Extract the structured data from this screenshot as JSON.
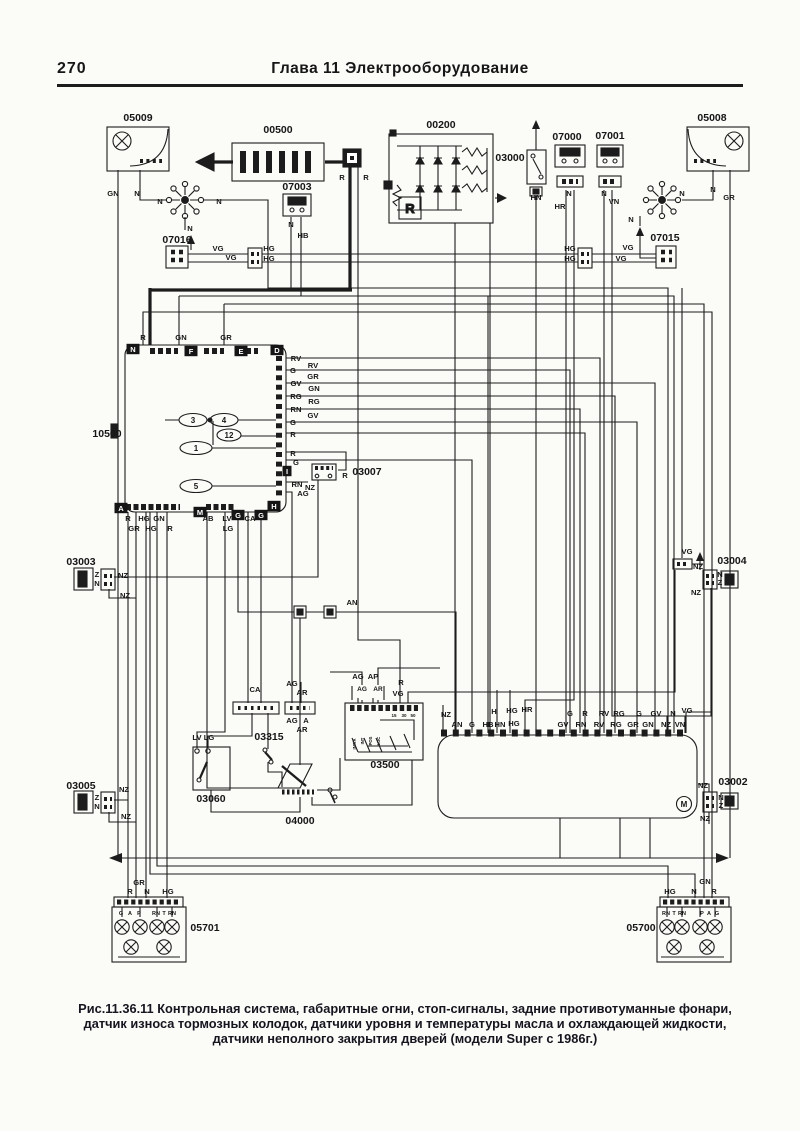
{
  "page": {
    "number": "270",
    "header": "Глава 11  Электрооборудование"
  },
  "caption": [
    "Рис.11.36.11 Контрольная система, габаритные огни, стоп-сигналы, задние противотуманные фонари,",
    "датчик износа тормозных колодок, датчики уровня и температуры масла и охлаждающей жидкости,",
    "датчики неполного закрытия дверей (модели Super с 1986г.)"
  ],
  "diagram": {
    "alternator_r": "R",
    "components": [
      {
        "id": "05009",
        "x": 138,
        "y": 121
      },
      {
        "id": "00500",
        "x": 278,
        "y": 133
      },
      {
        "id": "07003",
        "x": 297,
        "y": 190
      },
      {
        "id": "00200",
        "x": 441,
        "y": 128
      },
      {
        "id": "03000",
        "x": 510,
        "y": 161
      },
      {
        "id": "07000",
        "x": 567,
        "y": 140
      },
      {
        "id": "07001",
        "x": 610,
        "y": 139
      },
      {
        "id": "05008",
        "x": 712,
        "y": 121
      },
      {
        "id": "07016",
        "x": 177,
        "y": 243
      },
      {
        "id": "07015",
        "x": 665,
        "y": 241
      },
      {
        "id": "10500",
        "x": 107,
        "y": 437
      },
      {
        "id": "03007",
        "x": 367,
        "y": 475
      },
      {
        "id": "03003",
        "x": 81,
        "y": 565
      },
      {
        "id": "03004",
        "x": 732,
        "y": 564
      },
      {
        "id": "03005",
        "x": 81,
        "y": 789
      },
      {
        "id": "03002",
        "x": 733,
        "y": 785
      },
      {
        "id": "03315",
        "x": 269,
        "y": 740
      },
      {
        "id": "03060",
        "x": 211,
        "y": 802
      },
      {
        "id": "04000",
        "x": 300,
        "y": 824
      },
      {
        "id": "03500",
        "x": 385,
        "y": 768
      },
      {
        "id": "05701",
        "x": 205,
        "y": 931
      },
      {
        "id": "05700",
        "x": 641,
        "y": 931
      }
    ],
    "badges": [
      {
        "t": "N",
        "x": 133,
        "y": 349
      },
      {
        "t": "F",
        "x": 191,
        "y": 351
      },
      {
        "t": "E",
        "x": 241,
        "y": 351
      },
      {
        "t": "D",
        "x": 277,
        "y": 350
      },
      {
        "t": "A",
        "x": 121,
        "y": 508
      },
      {
        "t": "M",
        "x": 200,
        "y": 512
      },
      {
        "t": "G",
        "x": 238,
        "y": 515
      },
      {
        "t": "G",
        "x": 261,
        "y": 515
      },
      {
        "t": "H",
        "x": 274,
        "y": 506
      },
      {
        "t": "I",
        "x": 287,
        "y": 471
      }
    ],
    "oval_numbers": [
      {
        "t": "3",
        "x": 193,
        "y": 423
      },
      {
        "t": "4",
        "x": 224,
        "y": 423
      },
      {
        "t": "12",
        "x": 229,
        "y": 438
      },
      {
        "t": "1",
        "x": 196,
        "y": 451
      },
      {
        "t": "5",
        "x": 196,
        "y": 489
      }
    ],
    "switch_labels": [
      {
        "t": "INT/A",
        "x": 356,
        "y": 744
      },
      {
        "t": "INT",
        "x": 364,
        "y": 741
      },
      {
        "t": "POS",
        "x": 372,
        "y": 741
      },
      {
        "t": "LUC",
        "x": 380,
        "y": 741
      }
    ],
    "wire_labels": [
      {
        "t": "GN",
        "x": 113,
        "y": 196
      },
      {
        "t": "N",
        "x": 137,
        "y": 196
      },
      {
        "t": "N",
        "x": 160,
        "y": 204
      },
      {
        "t": "N",
        "x": 219,
        "y": 204
      },
      {
        "t": "N",
        "x": 190,
        "y": 231
      },
      {
        "t": "R",
        "x": 342,
        "y": 180
      },
      {
        "t": "R",
        "x": 366,
        "y": 180
      },
      {
        "t": "N",
        "x": 291,
        "y": 227
      },
      {
        "t": "HB",
        "x": 303,
        "y": 238
      },
      {
        "t": "HN",
        "x": 536,
        "y": 200
      },
      {
        "t": "N",
        "x": 569,
        "y": 196
      },
      {
        "t": "HR",
        "x": 560,
        "y": 209
      },
      {
        "t": "N",
        "x": 604,
        "y": 196
      },
      {
        "t": "VN",
        "x": 614,
        "y": 204
      },
      {
        "t": "N",
        "x": 713,
        "y": 192
      },
      {
        "t": "GR",
        "x": 729,
        "y": 200
      },
      {
        "t": "N",
        "x": 682,
        "y": 196
      },
      {
        "t": "N",
        "x": 631,
        "y": 222
      },
      {
        "t": "VG",
        "x": 218,
        "y": 251
      },
      {
        "t": "VG",
        "x": 231,
        "y": 260
      },
      {
        "t": "HG",
        "x": 269,
        "y": 251
      },
      {
        "t": "HG",
        "x": 269,
        "y": 261
      },
      {
        "t": "HG",
        "x": 570,
        "y": 251
      },
      {
        "t": "HG",
        "x": 570,
        "y": 261
      },
      {
        "t": "VG",
        "x": 628,
        "y": 250
      },
      {
        "t": "VG",
        "x": 621,
        "y": 261
      },
      {
        "t": "R",
        "x": 143,
        "y": 340
      },
      {
        "t": "GN",
        "x": 181,
        "y": 340
      },
      {
        "t": "GR",
        "x": 226,
        "y": 340
      },
      {
        "t": "RV",
        "x": 296,
        "y": 361
      },
      {
        "t": "G",
        "x": 293,
        "y": 373
      },
      {
        "t": "GV",
        "x": 296,
        "y": 386
      },
      {
        "t": "RG",
        "x": 296,
        "y": 399
      },
      {
        "t": "RN",
        "x": 296,
        "y": 412
      },
      {
        "t": "G",
        "x": 293,
        "y": 425
      },
      {
        "t": "R",
        "x": 293,
        "y": 437
      },
      {
        "t": "R",
        "x": 293,
        "y": 456
      },
      {
        "t": "G",
        "x": 296,
        "y": 465
      },
      {
        "t": "RN",
        "x": 297,
        "y": 487
      },
      {
        "t": "AG",
        "x": 303,
        "y": 496
      },
      {
        "t": "RV",
        "x": 313,
        "y": 368
      },
      {
        "t": "GR",
        "x": 313,
        "y": 379
      },
      {
        "t": "GN",
        "x": 314,
        "y": 391
      },
      {
        "t": "RG",
        "x": 314,
        "y": 404
      },
      {
        "t": "GV",
        "x": 313,
        "y": 418
      },
      {
        "t": "NZ",
        "x": 310,
        "y": 490
      },
      {
        "t": "R",
        "x": 345,
        "y": 478
      },
      {
        "t": "R",
        "x": 128,
        "y": 521
      },
      {
        "t": "HG",
        "x": 144,
        "y": 521
      },
      {
        "t": "GN",
        "x": 159,
        "y": 521
      },
      {
        "t": "GR",
        "x": 134,
        "y": 531
      },
      {
        "t": "HG",
        "x": 151,
        "y": 531
      },
      {
        "t": "R",
        "x": 170,
        "y": 531
      },
      {
        "t": "AB",
        "x": 208,
        "y": 521
      },
      {
        "t": "LV",
        "x": 227,
        "y": 521
      },
      {
        "t": "LG",
        "x": 228,
        "y": 531
      },
      {
        "t": "CA",
        "x": 250,
        "y": 521
      },
      {
        "t": "Z",
        "x": 97,
        "y": 577
      },
      {
        "t": "N",
        "x": 97,
        "y": 586
      },
      {
        "t": "NZ",
        "x": 123,
        "y": 578
      },
      {
        "t": "NZ",
        "x": 125,
        "y": 598
      },
      {
        "t": "VG",
        "x": 687,
        "y": 554
      },
      {
        "t": "NZ",
        "x": 698,
        "y": 569
      },
      {
        "t": "N",
        "x": 720,
        "y": 577
      },
      {
        "t": "Z",
        "x": 720,
        "y": 585
      },
      {
        "t": "NZ",
        "x": 696,
        "y": 595
      },
      {
        "t": "Z",
        "x": 97,
        "y": 800
      },
      {
        "t": "N",
        "x": 97,
        "y": 809
      },
      {
        "t": "NZ",
        "x": 124,
        "y": 792
      },
      {
        "t": "NZ",
        "x": 126,
        "y": 819
      },
      {
        "t": "NZ",
        "x": 703,
        "y": 788
      },
      {
        "t": "N",
        "x": 721,
        "y": 800
      },
      {
        "t": "Z",
        "x": 721,
        "y": 808
      },
      {
        "t": "NZ",
        "x": 705,
        "y": 821
      },
      {
        "t": "M",
        "x": 684,
        "y": 807,
        "s": 8
      },
      {
        "t": "AN",
        "x": 352,
        "y": 605
      },
      {
        "t": "CA",
        "x": 255,
        "y": 692
      },
      {
        "t": "AG",
        "x": 292,
        "y": 686
      },
      {
        "t": "AR",
        "x": 302,
        "y": 695
      },
      {
        "t": "AG",
        "x": 292,
        "y": 723
      },
      {
        "t": "A",
        "x": 306,
        "y": 723
      },
      {
        "t": "AR",
        "x": 302,
        "y": 732
      },
      {
        "t": "LV",
        "x": 197,
        "y": 740
      },
      {
        "t": "LG",
        "x": 209,
        "y": 740
      },
      {
        "t": "AG",
        "x": 358,
        "y": 679
      },
      {
        "t": "AP",
        "x": 373,
        "y": 679
      },
      {
        "t": "AG",
        "x": 362,
        "y": 691,
        "s": 6.5
      },
      {
        "t": "AR",
        "x": 378,
        "y": 691,
        "s": 6.5
      },
      {
        "t": "R",
        "x": 401,
        "y": 685
      },
      {
        "t": "VG",
        "x": 398,
        "y": 696
      },
      {
        "t": "15",
        "x": 394,
        "y": 717,
        "s": 4.5
      },
      {
        "t": "30",
        "x": 404,
        "y": 717,
        "s": 4.5
      },
      {
        "t": "50",
        "x": 413,
        "y": 717,
        "s": 4.5
      },
      {
        "t": "NZ",
        "x": 446,
        "y": 717
      },
      {
        "t": "H",
        "x": 494,
        "y": 714
      },
      {
        "t": "HG",
        "x": 512,
        "y": 713
      },
      {
        "t": "HR",
        "x": 527,
        "y": 712
      },
      {
        "t": "G",
        "x": 570,
        "y": 716
      },
      {
        "t": "R",
        "x": 585,
        "y": 716
      },
      {
        "t": "RV",
        "x": 604,
        "y": 716
      },
      {
        "t": "RG",
        "x": 619,
        "y": 716
      },
      {
        "t": "G",
        "x": 639,
        "y": 716
      },
      {
        "t": "GV",
        "x": 656,
        "y": 716
      },
      {
        "t": "N",
        "x": 673,
        "y": 716
      },
      {
        "t": "VG",
        "x": 687,
        "y": 713
      },
      {
        "t": "AN",
        "x": 457,
        "y": 727
      },
      {
        "t": "G",
        "x": 472,
        "y": 727
      },
      {
        "t": "HB",
        "x": 488,
        "y": 727
      },
      {
        "t": "HN",
        "x": 500,
        "y": 727
      },
      {
        "t": "HG",
        "x": 514,
        "y": 726
      },
      {
        "t": "GV",
        "x": 563,
        "y": 727
      },
      {
        "t": "RN",
        "x": 581,
        "y": 727
      },
      {
        "t": "RV",
        "x": 599,
        "y": 727
      },
      {
        "t": "RG",
        "x": 616,
        "y": 727
      },
      {
        "t": "GR",
        "x": 633,
        "y": 727
      },
      {
        "t": "GN",
        "x": 648,
        "y": 727
      },
      {
        "t": "NZ",
        "x": 666,
        "y": 727
      },
      {
        "t": "VN",
        "x": 680,
        "y": 727
      },
      {
        "t": "GR",
        "x": 139,
        "y": 885
      },
      {
        "t": "R",
        "x": 130,
        "y": 894
      },
      {
        "t": "N",
        "x": 147,
        "y": 894
      },
      {
        "t": "HG",
        "x": 168,
        "y": 894
      },
      {
        "t": "G",
        "x": 121,
        "y": 915,
        "s": 5.5
      },
      {
        "t": "A",
        "x": 130,
        "y": 915,
        "s": 5.5
      },
      {
        "t": "P",
        "x": 139,
        "y": 915,
        "s": 5.5
      },
      {
        "t": "RN",
        "x": 156,
        "y": 915,
        "s": 5.5
      },
      {
        "t": "T",
        "x": 164,
        "y": 915,
        "s": 5.5
      },
      {
        "t": "RN",
        "x": 172,
        "y": 915,
        "s": 5.5
      },
      {
        "t": "HG",
        "x": 670,
        "y": 894
      },
      {
        "t": "N",
        "x": 694,
        "y": 894
      },
      {
        "t": "GN",
        "x": 705,
        "y": 884
      },
      {
        "t": "R",
        "x": 714,
        "y": 894
      },
      {
        "t": "RN",
        "x": 666,
        "y": 915,
        "s": 5.5
      },
      {
        "t": "T",
        "x": 674,
        "y": 915,
        "s": 5.5
      },
      {
        "t": "RN",
        "x": 682,
        "y": 915,
        "s": 5.5
      },
      {
        "t": "P",
        "x": 702,
        "y": 915,
        "s": 5.5
      },
      {
        "t": "A",
        "x": 709,
        "y": 915,
        "s": 5.5
      },
      {
        "t": "G",
        "x": 717,
        "y": 915,
        "s": 5.5
      }
    ]
  }
}
